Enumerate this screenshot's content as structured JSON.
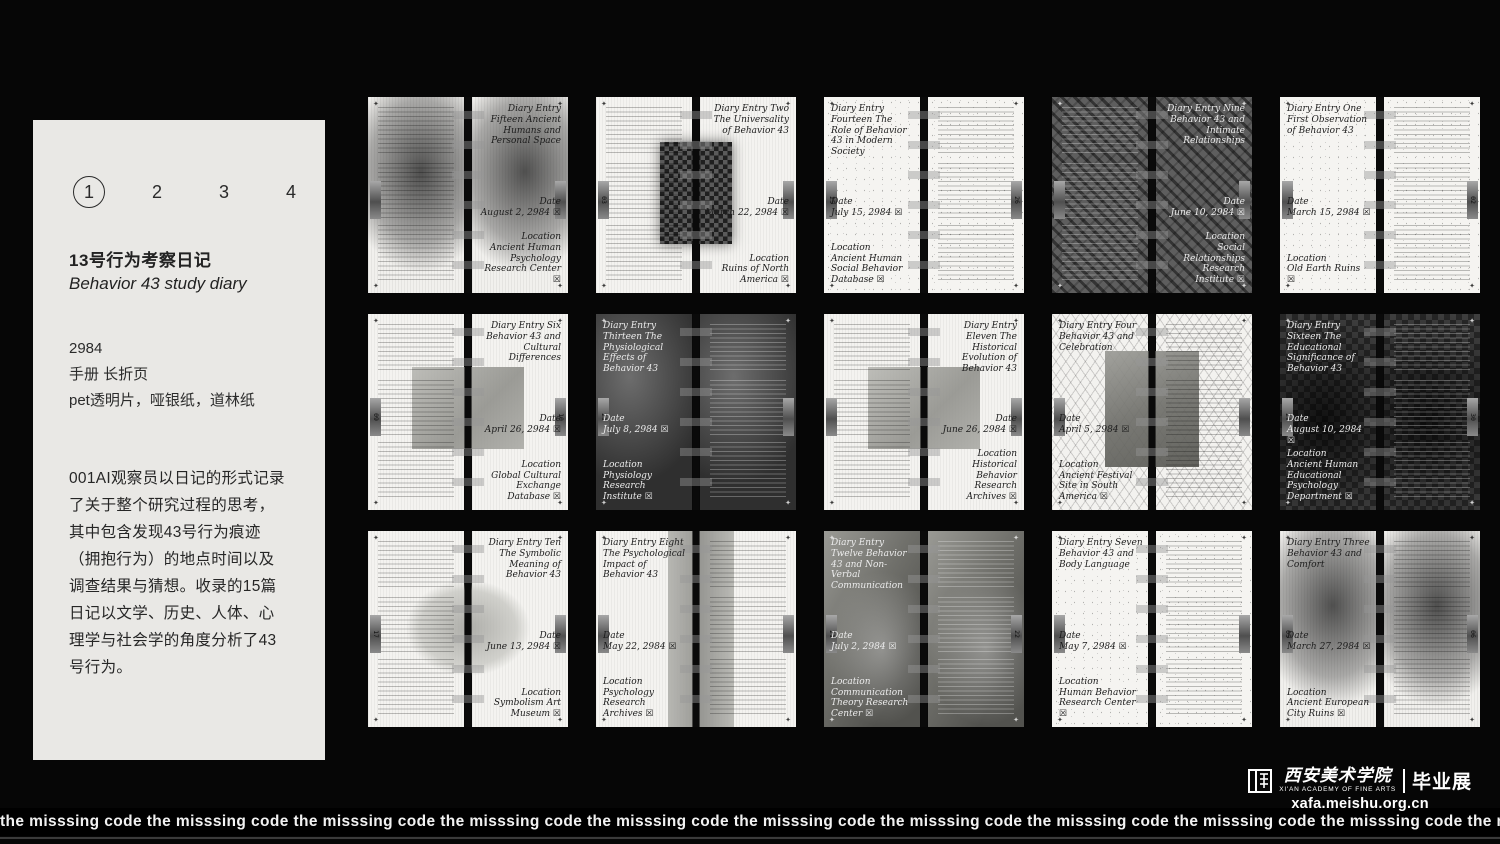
{
  "left_panel": {
    "pagination": {
      "items": [
        "1",
        "2",
        "3",
        "4"
      ],
      "active_index": 0
    },
    "title_cn": "13号行为考察日记",
    "title_en": "Behavior 43 study diary",
    "year": "2984",
    "format_line1": "手册 长折页",
    "format_line2": "pet透明片，哑银纸，道林纸",
    "description": "001AI观察员以日记的形式记录了关于整个研究过程的思考，其中包含发现43号行为痕迹（拥抱行为）的地点时间以及调查结果与猜想。收录的15篇日记以文学、历史、人体、心理学与社会学的角度分析了43号行为。"
  },
  "labels": {
    "date": "Date",
    "location": "Location",
    "checkbox": "☒"
  },
  "spreads": [
    {
      "title": "Diary Entry Fifteen Ancient Humans and Personal Space",
      "date": "August 2, 2984",
      "location": "Ancient Human Psychology Research Center",
      "title_side": "right",
      "theme": "smudge",
      "photo": "none",
      "dark": false,
      "tabs": [
        "",
        ""
      ]
    },
    {
      "title": "Diary Entry Two The Universality of Behavior 43",
      "date": "March 22, 2984",
      "location": "Ruins of North America",
      "title_side": "right",
      "theme": "light",
      "photo": "checker",
      "dark": false,
      "tabs": [
        "03",
        ""
      ]
    },
    {
      "title": "Diary Entry Fourteen The Role of Behavior 43 in Modern Society",
      "date": "July 15, 2984",
      "location": "Ancient Human Social Behavior Database",
      "title_side": "left",
      "theme": "sketch",
      "photo": "none",
      "dark": false,
      "tabs": [
        "25",
        "26"
      ]
    },
    {
      "title": "Diary Entry Nine Behavior 43 and Intimate Relationships",
      "date": "June 10, 2984",
      "location": "Social Relationships Research Institute",
      "title_side": "right",
      "theme": "dark1",
      "photo": "none",
      "dark": true,
      "tabs": [
        "",
        ""
      ]
    },
    {
      "title": "Diary Entry One First Observation of Behavior 43",
      "date": "March 15, 2984",
      "location": "Old Earth Ruins",
      "title_side": "left",
      "theme": "sketch",
      "photo": "none",
      "dark": false,
      "tabs": [
        "",
        "02"
      ]
    },
    {
      "title": "Diary Entry Six Behavior 43 and Cultural Differences",
      "date": "April 26, 2984",
      "location": "Global Cultural Exchange Database",
      "title_side": "right",
      "theme": "light",
      "photo": "gray",
      "dark": false,
      "tabs": [
        "09",
        "10"
      ]
    },
    {
      "title": "Diary Entry Thirteen The Physiological Effects of Behavior 43",
      "date": "July 8, 2984",
      "location": "Physiology Research Institute",
      "title_side": "left",
      "theme": "dark2",
      "photo": "none",
      "dark": true,
      "tabs": [
        "23",
        ""
      ]
    },
    {
      "title": "Diary Entry Eleven The Historical Evolution of Behavior 43",
      "date": "June 26, 2984",
      "location": "Historical Behavior Research Archives",
      "title_side": "right",
      "theme": "light",
      "photo": "gray",
      "dark": false,
      "tabs": [
        "",
        ""
      ]
    },
    {
      "title": "Diary Entry Four Behavior 43 and Celebration",
      "date": "April 5, 2984",
      "location": "Ancient Festival Site in South America",
      "title_side": "left",
      "theme": "mesh",
      "photo": "tall",
      "dark": false,
      "tabs": [
        "",
        ""
      ]
    },
    {
      "title": "Diary Entry Sixteen The Educational Significance of Behavior 43",
      "date": "August 10, 2984",
      "location": "Ancient Human Educational Psychology Department",
      "title_side": "left",
      "theme": "checker",
      "photo": "none",
      "dark": true,
      "tabs": [
        "29",
        "30"
      ]
    },
    {
      "title": "Diary Entry Ten The Symbolic Meaning of Behavior 43",
      "date": "June 13, 2984",
      "location": "Symbolism Art Museum",
      "title_side": "right",
      "theme": "light",
      "photo": "soft",
      "dark": false,
      "tabs": [
        "17",
        ""
      ]
    },
    {
      "title": "Diary Entry Eight The Psychological Impact of Behavior 43",
      "date": "May 22, 2984",
      "location": "Psychology Research Archives",
      "title_side": "left",
      "theme": "light",
      "photo": "band",
      "dark": false,
      "tabs": [
        "",
        ""
      ]
    },
    {
      "title": "Diary Entry Twelve Behavior 43 and Non-Verbal Communication",
      "date": "July 2, 2984",
      "location": "Communication Theory Research Center",
      "title_side": "left",
      "theme": "pdark",
      "photo": "none",
      "dark": true,
      "tabs": [
        "21",
        "22"
      ]
    },
    {
      "title": "Diary Entry Seven Behavior 43 and Body Language",
      "date": "May 7, 2984",
      "location": "Human Behavior Research Center",
      "title_side": "left",
      "theme": "sketch",
      "photo": "none",
      "dark": false,
      "tabs": [
        "",
        ""
      ]
    },
    {
      "title": "Diary Entry Three Behavior 43 and Comfort",
      "date": "March 27, 2984",
      "location": "Ancient European City Ruins",
      "title_side": "left",
      "theme": "smudge",
      "photo": "none",
      "dark": false,
      "tabs": [
        "05",
        "06"
      ]
    }
  ],
  "footer": {
    "ticker_text": "the misssing code",
    "academy_cn": "西安美术学院",
    "academy_en": "XI'AN ACADEMY OF FINE ARTS",
    "exhibition": "毕业展",
    "url": "xafa.meishu.org.cn"
  }
}
